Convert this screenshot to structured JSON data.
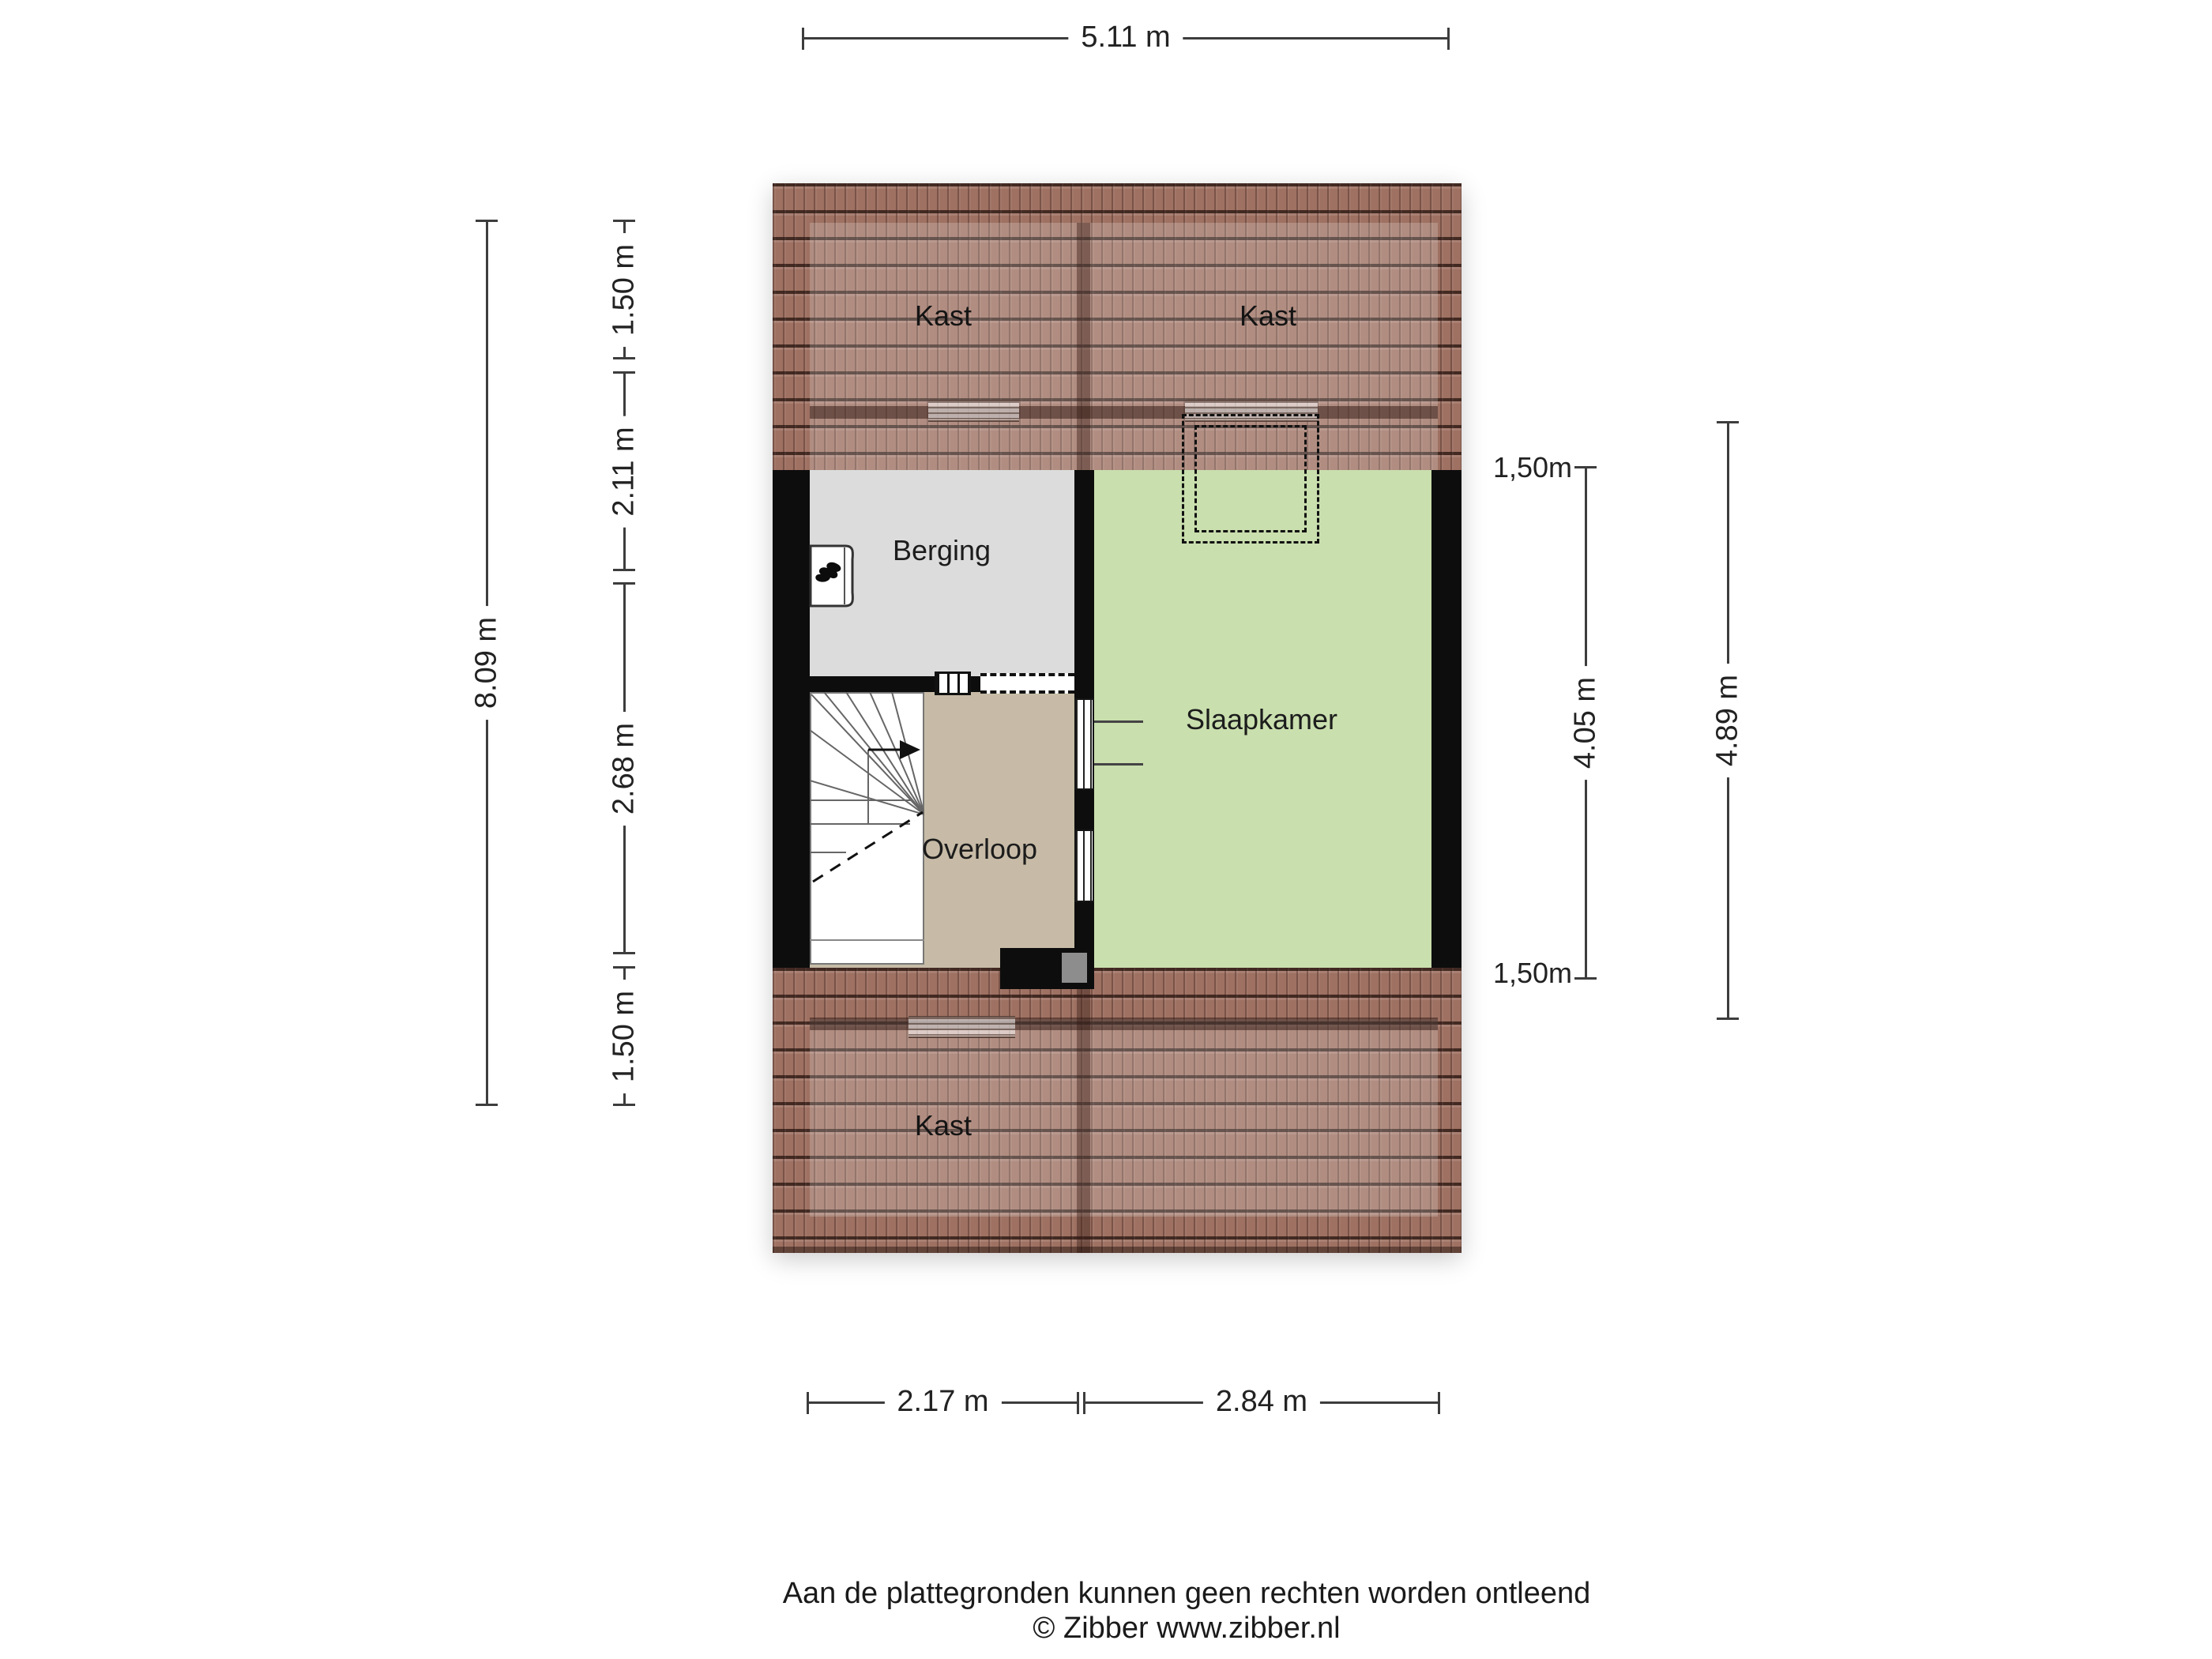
{
  "page": {
    "footer_disclaimer": "Aan de plattegronden kunnen geen rechten worden ontleend",
    "footer_copyright": "© Zibber www.zibber.nl"
  },
  "rooms": {
    "kast_top_left": "Kast",
    "kast_top_right": "Kast",
    "berging": "Berging",
    "slaapkamer": "Slaapkamer",
    "overloop": "Overloop",
    "kast_bottom": "Kast"
  },
  "dimensions": {
    "top_width": "5.11 m",
    "left_total_height": "8.09 m",
    "left_segments": [
      "1.50 m",
      "2.11 m",
      "2.68 m",
      "1.50 m"
    ],
    "right_knee_top": "1,50m",
    "right_room_height": "4.05 m",
    "right_knee_bottom": "1,50m",
    "right_total_height": "4.89 m",
    "bottom_segments": [
      "2.17 m",
      "2.84 m"
    ]
  },
  "colors": {
    "roof_tile": "#9e7162",
    "berging_floor": "#dcdcdc",
    "slaapkamer_floor": "#c9dfae",
    "overloop_floor": "#c7bba7",
    "wall": "#0d0d0d",
    "dimension_line": "#3d3d3d"
  },
  "icons": {
    "boiler": "flame-icon",
    "stairs_direction": "up-arrow-icon"
  }
}
